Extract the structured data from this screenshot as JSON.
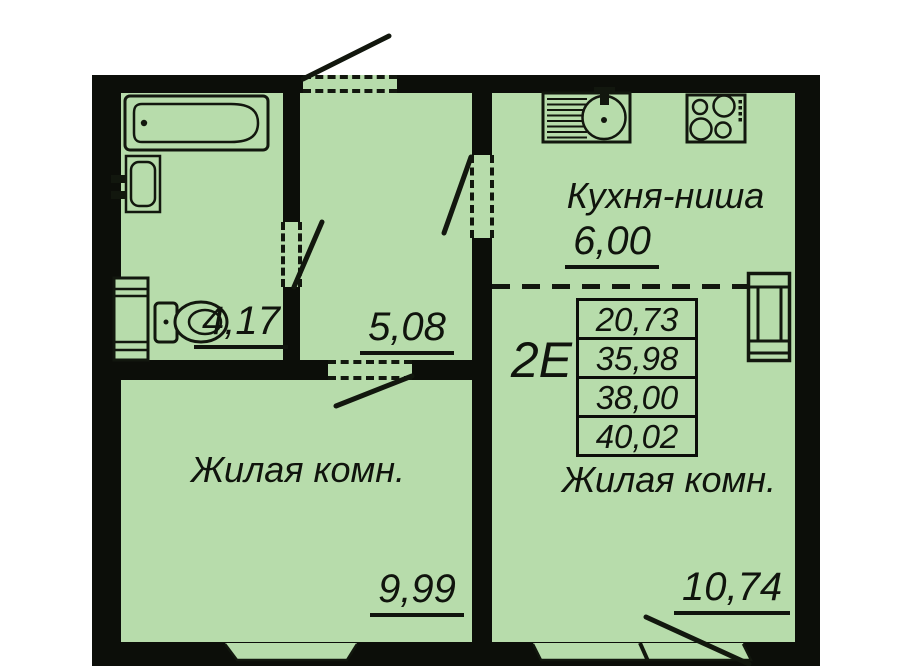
{
  "colors": {
    "room_fill": "#b7dcab",
    "wall": "#0c0e09",
    "line": "#12170e",
    "text": "#10140d",
    "background": "#ffffff"
  },
  "rooms": {
    "kitchen_niche": {
      "name": "Кухня-ниша",
      "area": "6,00"
    },
    "bathroom": {
      "area": "4,17"
    },
    "hallway": {
      "area": "5,08"
    },
    "living_left": {
      "name": "Жилая комн.",
      "area": "9,99"
    },
    "living_right": {
      "name": "Жилая комн.",
      "area": "10,74"
    }
  },
  "unit": {
    "type_label": "2Е",
    "areas": [
      "20,73",
      "35,98",
      "38,00",
      "40,02"
    ]
  },
  "fixtures": [
    "bathtub",
    "washbasin",
    "washing-machine",
    "toilet",
    "kitchen-sink",
    "stove",
    "vent-shaft"
  ]
}
